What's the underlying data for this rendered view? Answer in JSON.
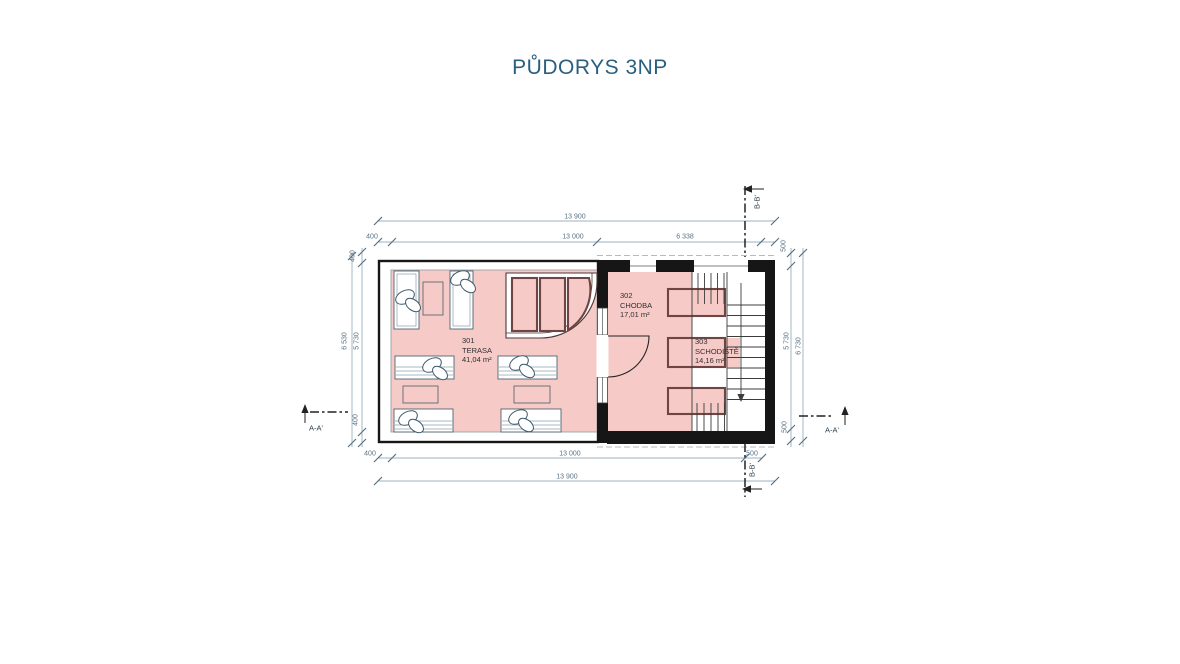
{
  "title": "PŮDORYS 3NP",
  "rooms": [
    {
      "number": "301",
      "name": "TERASA",
      "area": "41,04 m²"
    },
    {
      "number": "302",
      "name": "CHODBA",
      "area": "17,01 m²"
    },
    {
      "number": "303",
      "name": "SCHODIŠTĚ",
      "area": "14,16 m²"
    }
  ],
  "dims": {
    "top_overall": "13 900",
    "top_seg_400": "400",
    "top_seg_13000": "13 000",
    "top_seg_6338": "6 338",
    "bottom_seg_400": "400",
    "bottom_seg_13000": "13 000",
    "bottom_seg_500": "500",
    "bottom_overall": "13 900",
    "left_outer": "6 530",
    "left_seg_400_top": "400",
    "left_seg_5730": "5 730",
    "left_seg_400_bottom": "400",
    "right_seg_500_top": "500",
    "right_seg_5730": "5 730",
    "right_seg_500_bottom": "500",
    "right_outer": "6 730"
  },
  "sections": {
    "a": "A-A'",
    "b": "B-B'"
  },
  "colors": {
    "accent": "#2a5f7f",
    "dimtext": "#587285",
    "dimline": "#9db0bc",
    "pink": "#f6cac7",
    "maroon": "#6f4543",
    "wall": "#161616",
    "room_label": "#303030"
  }
}
